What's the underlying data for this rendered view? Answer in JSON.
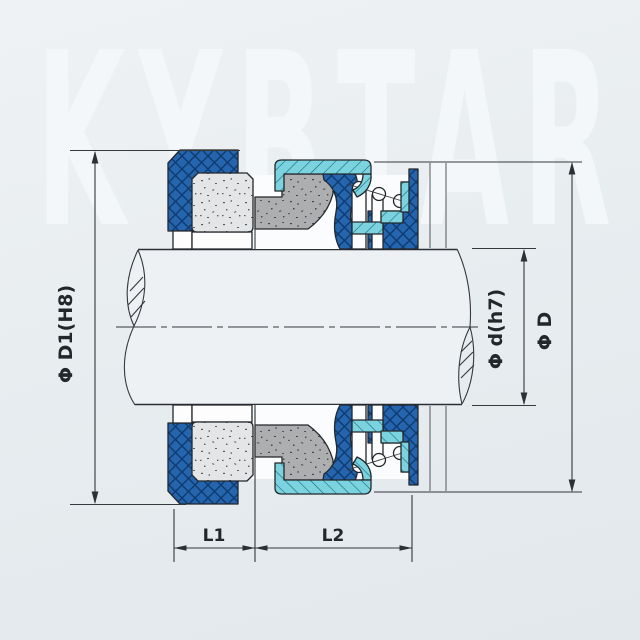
{
  "watermark": {
    "text": "KYBTAR"
  },
  "diagram": {
    "type": "mechanical-seal-cross-section",
    "labels": {
      "bore_diameter": "Φ D1(H8)",
      "shaft_diameter": "Φ d(h7)",
      "outer_diameter": "Φ D",
      "length1": "L1",
      "length2": "L2"
    },
    "colors": {
      "elastomer_blue": "#2565ae",
      "retainer_cyan": "#7bd3e0",
      "seat_light_gray": "#e3e5e6",
      "carbon_gray": "#acaeb0",
      "line": "#2b2f33",
      "background": "#e8edf0",
      "watermark": "#f4f7f9"
    }
  }
}
